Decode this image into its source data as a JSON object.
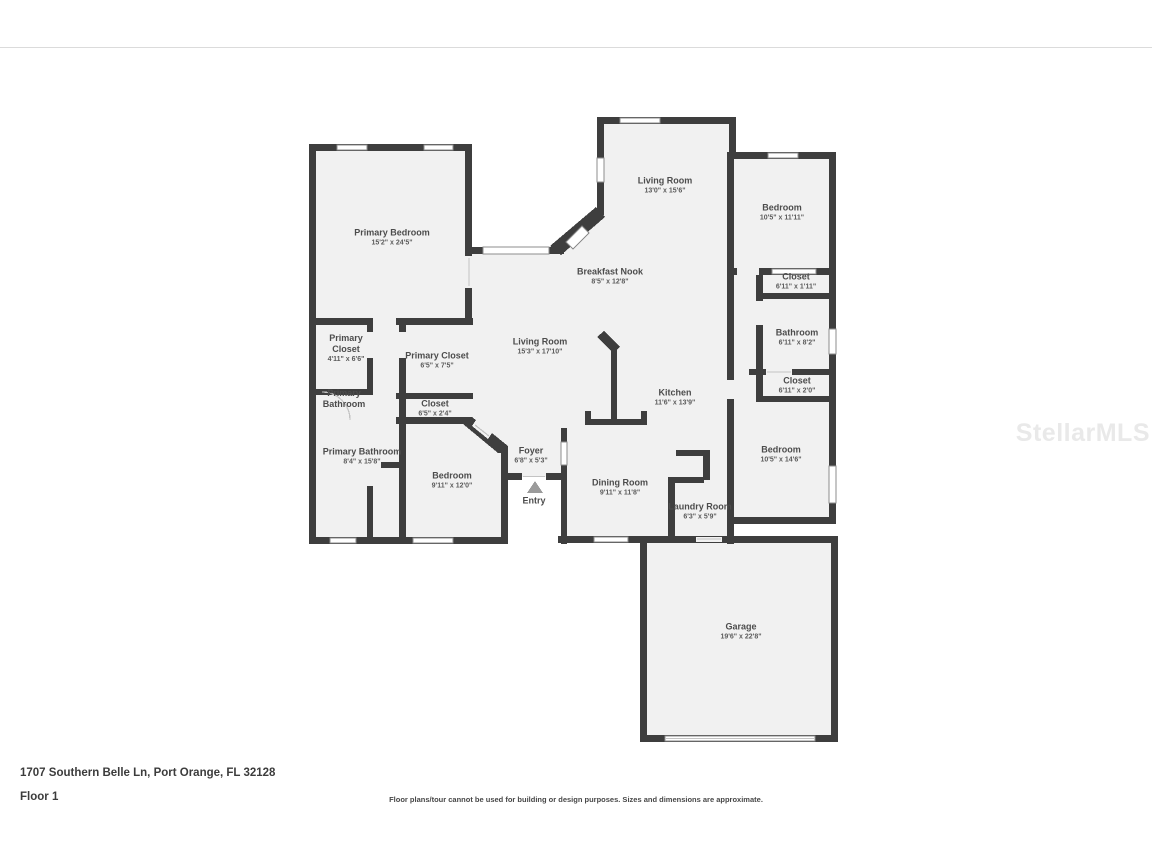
{
  "page": {
    "address": "1707 Southern Belle Ln, Port Orange, FL 32128",
    "floor_label": "Floor 1",
    "disclaimer": "Floor plans/tour cannot be used for building or design purposes. Sizes and dimensions are approximate.",
    "watermark": "StellarMLS"
  },
  "colors": {
    "wall": "#3e3e3e",
    "room_fill": "#f1f1f1",
    "label_text": "#4c4c4c",
    "dims_text": "#5b5b5b",
    "watermark": "#e9e9e9",
    "window_outline": "#8d8d8d"
  },
  "rooms": [
    {
      "label": "Primary Bedroom",
      "dims": "15'2\" x 24'5\""
    },
    {
      "label": "Living Room",
      "dims": "13'0\" x 15'6\""
    },
    {
      "label": "Bedroom",
      "dims": "10'5\" x 11'11\""
    },
    {
      "label": "Breakfast Nook",
      "dims": "8'5\" x 12'8\""
    },
    {
      "label": "Closet",
      "dims": "6'11\" x 1'11\""
    },
    {
      "label": "Bathroom",
      "dims": "6'11\" x 8'2\""
    },
    {
      "label": "Primary Closet",
      "dims": "4'11\" x 6'6\""
    },
    {
      "label": "Primary Closet",
      "dims": "6'5\" x 7'5\""
    },
    {
      "label": "Living Room",
      "dims": "15'3\" x 17'10\""
    },
    {
      "label": "Kitchen",
      "dims": "11'6\" x 13'9\""
    },
    {
      "label": "Closet",
      "dims": "6'11\" x 2'0\""
    },
    {
      "label": "Primary Bathroom",
      "dims": ""
    },
    {
      "label": "Closet",
      "dims": "6'5\" x 2'4\""
    },
    {
      "label": "Bedroom",
      "dims": "10'5\" x 14'6\""
    },
    {
      "label": "Primary Bathroom",
      "dims": "8'4\" x 15'8\""
    },
    {
      "label": "Bedroom",
      "dims": "9'11\" x 12'0\""
    },
    {
      "label": "Foyer",
      "dims": "6'8\" x 5'3\""
    },
    {
      "label": "Dining Room",
      "dims": "9'11\" x 11'8\""
    },
    {
      "label": "Laundry Room",
      "dims": "6'3\" x 5'9\""
    },
    {
      "label": "Entry",
      "dims": ""
    },
    {
      "label": "Garage",
      "dims": "19'6\" x 22'8\""
    }
  ]
}
